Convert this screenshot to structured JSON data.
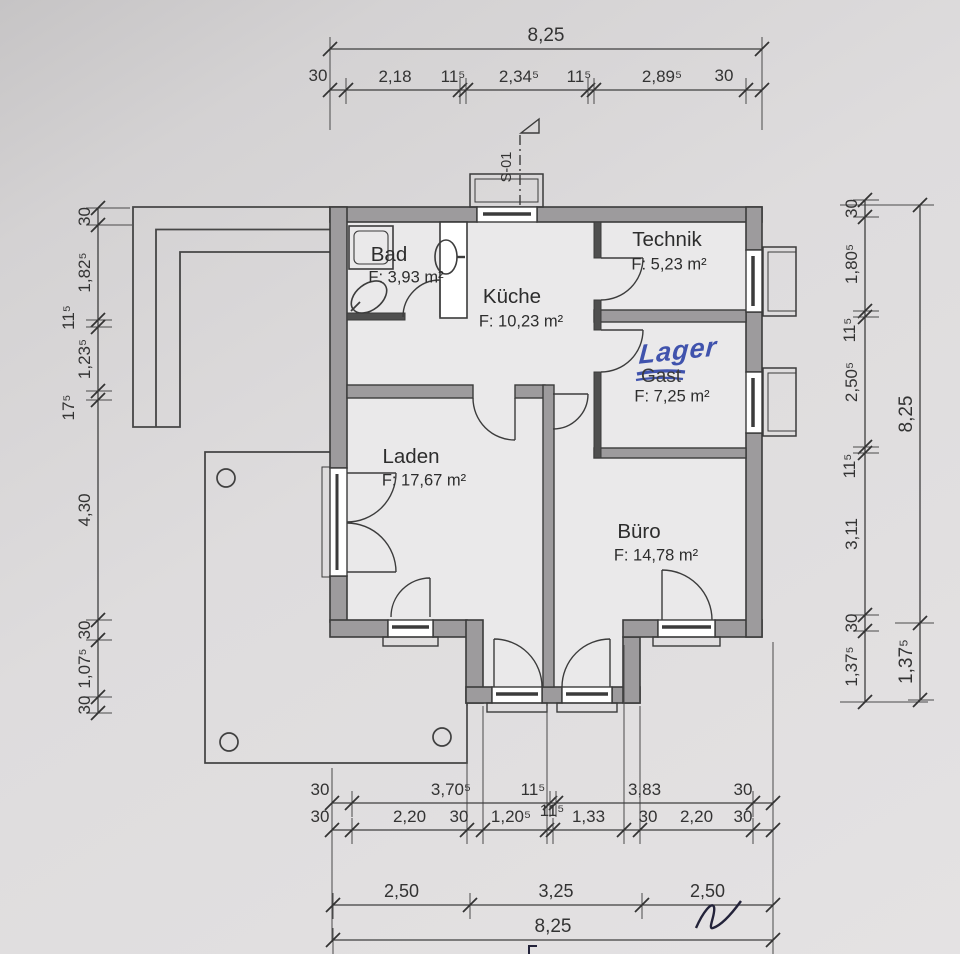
{
  "rooms": [
    {
      "name": "Bad",
      "area": "F: 3,93 m²"
    },
    {
      "name": "Küche",
      "area": "F: 10,23 m²"
    },
    {
      "name": "Technik",
      "area": "F: 5,23 m²"
    },
    {
      "name": "Lager",
      "area": "F: 7,25 m²"
    },
    {
      "name": "Laden",
      "area": "F: 17,67 m²"
    },
    {
      "name": "Büro",
      "area": "F: 14,78 m²"
    }
  ],
  "annotations": {
    "section_marker": "S-01",
    "handwritten_room_name": "Lager",
    "struck_room_name": "Gast"
  },
  "dims": {
    "top_overall": [
      "8,25"
    ],
    "top": [
      "30",
      "2,18",
      "11⁵",
      "2,34⁵",
      "11⁵",
      "2,89⁵",
      "30"
    ],
    "left": [
      "30",
      "1,82⁵",
      "11⁵",
      "1,23⁵",
      "17⁵",
      "4,30",
      "30",
      "1,07⁵",
      "30"
    ],
    "right_inner": [
      "30",
      "1,80⁵",
      "11⁵",
      "2,50⁵",
      "11⁵",
      "3,11",
      "30",
      "1,37⁵"
    ],
    "right_outer": [
      "8,25",
      "1,37⁵"
    ],
    "bottom_1": [
      "30",
      "3,70⁵",
      "11⁵",
      "3,83",
      "30"
    ],
    "bottom_2": [
      "30",
      "2,20",
      "30",
      "1,20⁵",
      "11⁵",
      "1,33",
      "30",
      "2,20",
      "30"
    ],
    "bottom_3": [
      "2,50",
      "3,25",
      "2,50"
    ],
    "bottom_overall": [
      "8,25"
    ]
  },
  "colors": {
    "paper": "#dedcdd",
    "wall_fill": "#9d9b9d",
    "line": "#3b3b3b",
    "handwriting_blue": "#4053ad"
  }
}
